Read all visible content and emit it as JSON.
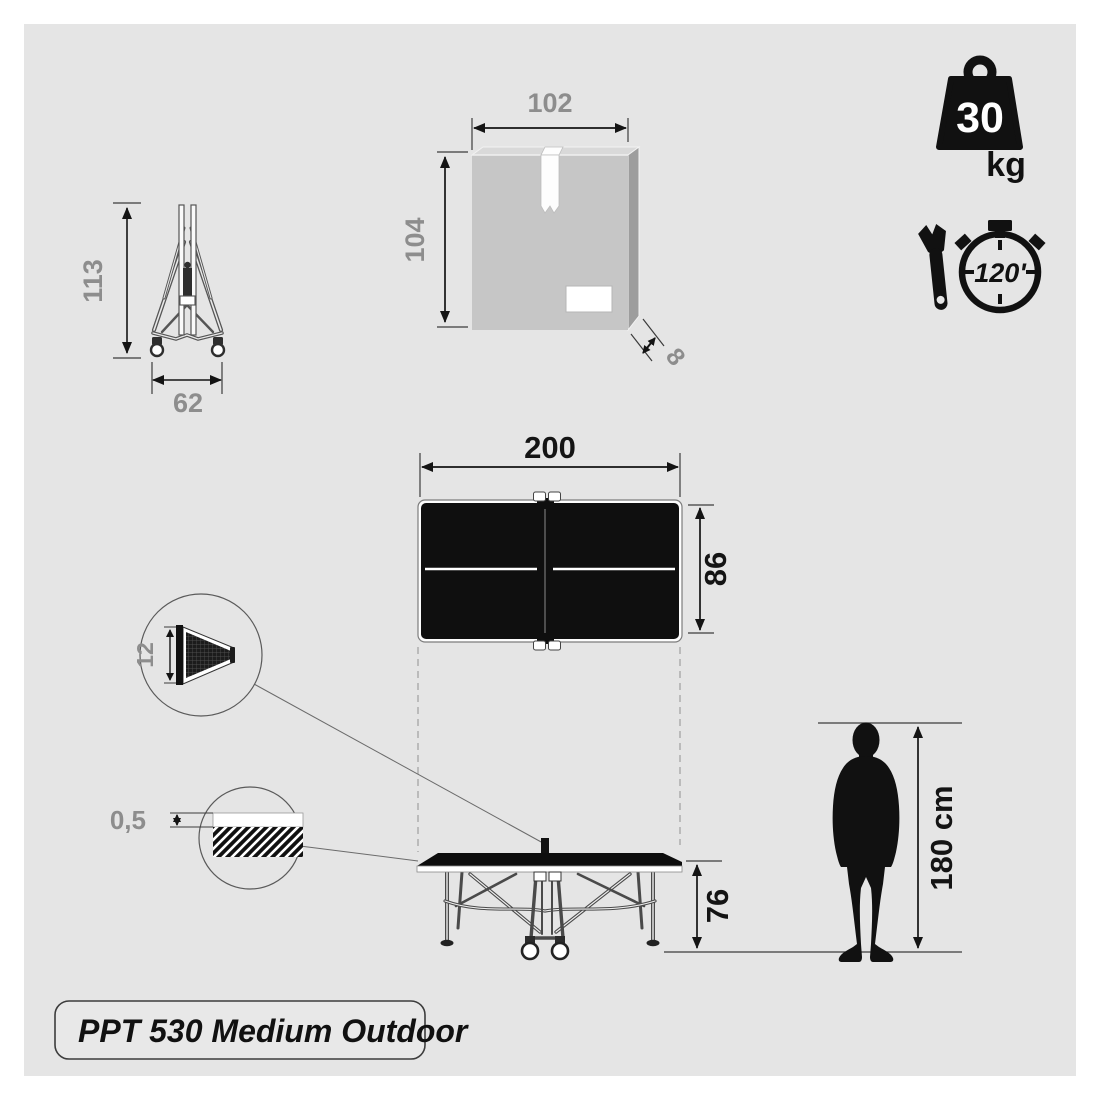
{
  "title": {
    "label": "PPT 530 Medium Outdoor"
  },
  "badges": {
    "weight": {
      "value": "30",
      "unit": "kg"
    },
    "assembly_time": {
      "value": "120'"
    }
  },
  "folded": {
    "height": "113",
    "width": "62"
  },
  "box": {
    "width": "102",
    "height": "104",
    "depth": "8"
  },
  "table": {
    "length": "200",
    "width": "86",
    "height": "76",
    "net_height": "12",
    "top_thickness": "0,5"
  },
  "person": {
    "height": "180 cm"
  },
  "colors": {
    "canvas_bg": "#e5e5e5",
    "ink": "#141414",
    "dim_text_gray": "#8d8d8d",
    "box_front": "#c6c6c6",
    "box_top": "#d9d9d9",
    "box_side": "#9d9d9d"
  }
}
